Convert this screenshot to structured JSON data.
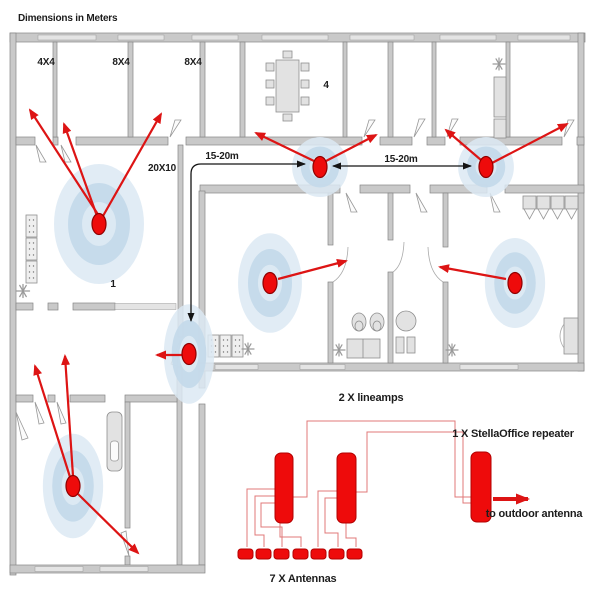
{
  "title": "Dimensions in Meters",
  "floor_plan": {
    "room_labels": [
      {
        "id": "room-4x4",
        "label": "4X4"
      },
      {
        "id": "room-8x4-a",
        "label": "8X4"
      },
      {
        "id": "room-8x4-b",
        "label": "8X4"
      },
      {
        "id": "meeting-room",
        "label": "4"
      },
      {
        "id": "open-office-20x10",
        "label": "20X10"
      },
      {
        "id": "zone-1",
        "label": "1"
      }
    ],
    "distance_labels": [
      {
        "label": "15-20m"
      },
      {
        "label": "15-20m"
      }
    ],
    "antenna_count": 7
  },
  "schematic": {
    "lineamps_label": "2 X lineamps",
    "repeater_label": "1 X StellaOffice repeater",
    "outdoor_antenna_label": "to outdoor antenna",
    "antennas_label": "7 X Antennas"
  },
  "colors": {
    "antenna_red": "#ee0b0b",
    "arrow_red": "#dd1414",
    "wire_red": "#e07878",
    "coverage_outer_blue": "#dce9f3",
    "coverage_mid_blue": "#c3d9ea",
    "wall_gray": "#c9c9c9",
    "text_black": "#1c1c1c"
  }
}
